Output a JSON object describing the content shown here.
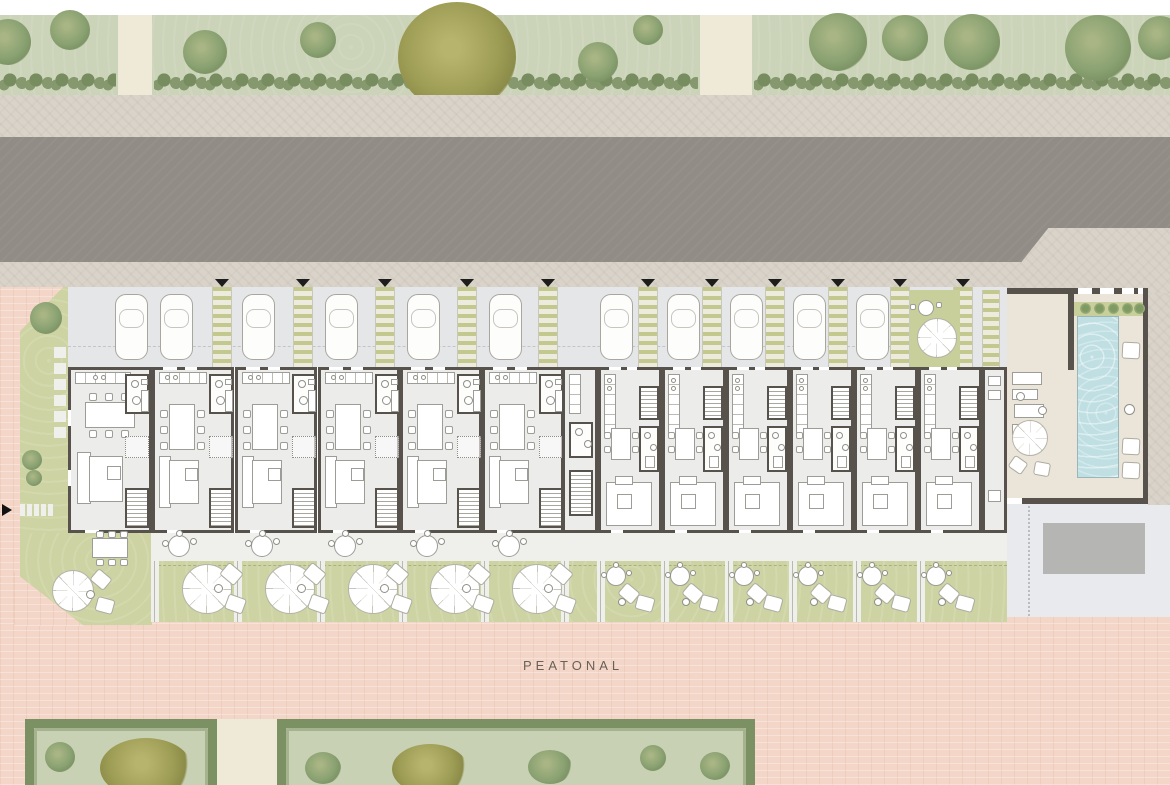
{
  "labels": {
    "pedestrian_zone": "PEATONAL"
  },
  "colors": {
    "road": "#918c85",
    "sidewalk": "#d9d3ca",
    "grass_belt": "#cbd3b8",
    "hedge": "#86996e",
    "hedge_dark": "#778d60",
    "lawn": "#cdd3a2",
    "courtyard": "#c8cf9b",
    "walkway_stripe": "#c2c88e",
    "parking_bg": "#e4e6e8",
    "wall": "#57524b",
    "floor": "#ececea",
    "furniture_line": "#9d9d97",
    "pink_paving": "#f3d6c8",
    "pool_water": "#bfdfe3",
    "pool_deck": "#ebe5d9",
    "plaza": "#e8eaed",
    "plaza_rect": "#b5b5b3",
    "path": "#efe9d8"
  },
  "site": {
    "wide_units": 6,
    "narrow_units": 6,
    "parking_cars": 12,
    "entrance_walkways": 11,
    "wide_garden_count": 5,
    "narrow_garden_count": 6,
    "pool_loungers": 3,
    "pool_sunbeds": 4
  }
}
